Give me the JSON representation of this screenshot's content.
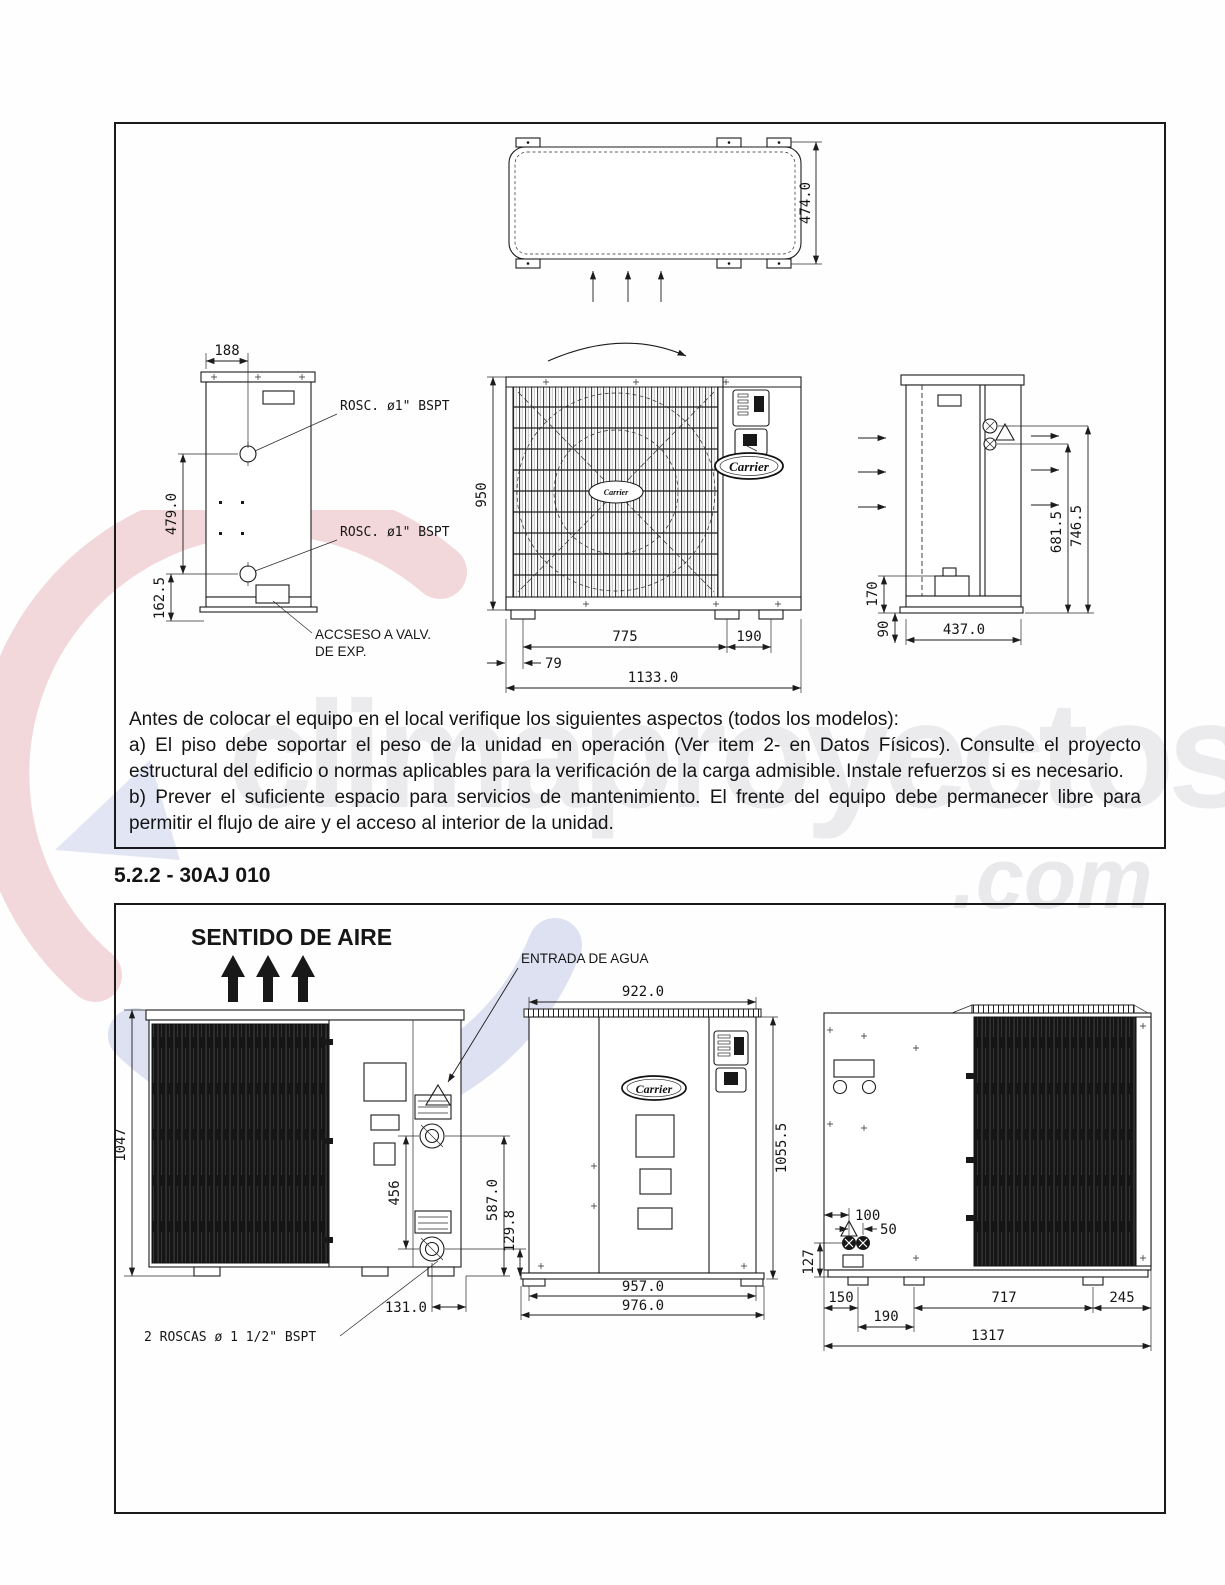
{
  "watermark": {
    "name": "climaproyectos",
    "tld": ".com"
  },
  "heading": "5.2.2 - 30AJ 010",
  "notes": {
    "intro": "Antes de colocar el equipo en el local verifique los siguientes aspectos (todos los modelos):",
    "item_a": "a) El piso debe soportar el peso de la unidad en operación (Ver item 2- en Datos Físicos). Consulte el proyecto estructural del edificio o normas aplicables para la verificación de la carga admisible. Instale refuerzos si es necesario.",
    "item_b": "b) Prever el suficiente espacio para servicios de mantenimiento. El frente del equipo debe permanecer libre para permitir el flujo de aire y el acceso al interior de la unidad."
  },
  "figure1": {
    "top_view": {
      "height_dim": "474.0"
    },
    "side_left_view": {
      "top_dim": "188",
      "mid_dim": "479.0",
      "bottom_dim": "162.5",
      "thread_label_upper": "ROSC. ø1\" BSPT",
      "thread_label_lower": "ROSC. ø1\" BSPT",
      "access_label_1": "ACCSESO A VALV.",
      "access_label_2": "DE EXP."
    },
    "front_view": {
      "brand": "Carrier",
      "height_dim": "950",
      "feet_span_dim": "775",
      "feet_right_dim": "190",
      "left_offset_dim": "79",
      "overall_width_dim": "1133.0"
    },
    "side_right_view": {
      "upper_conn_dim": "746.5",
      "lower_conn_dim": "681.5",
      "box_height_dim": "170",
      "base_height_dim": "90",
      "depth_dim": "437.0"
    }
  },
  "figure2": {
    "air_flow_label": "SENTIDO DE AIRE",
    "water_inlet_label": "ENTRADA DE AGUA",
    "thread_label": "2 ROSCAS ø 1 1/2\" BSPT",
    "side_left_view": {
      "height_dim": "1047",
      "conn_spacing_dim": "456",
      "upper_conn_dim": "587.0",
      "lower_conn_dim": "129.8",
      "conn_offset_dim": "131.0"
    },
    "front_view": {
      "brand": "Carrier",
      "top_width_dim": "922.0",
      "height_dim": "1055.5",
      "base_width_dim": "957.0",
      "overall_width_dim": "976.0"
    },
    "side_right_view": {
      "conn_offset_dim": "100",
      "conn_gap_dim": "50",
      "conn_height_dim": "127",
      "foot_offset_dim": "150",
      "foot_pair_dim": "190",
      "foot_span_dim": "717",
      "right_offset_dim": "245",
      "overall_width_dim": "1317"
    }
  }
}
